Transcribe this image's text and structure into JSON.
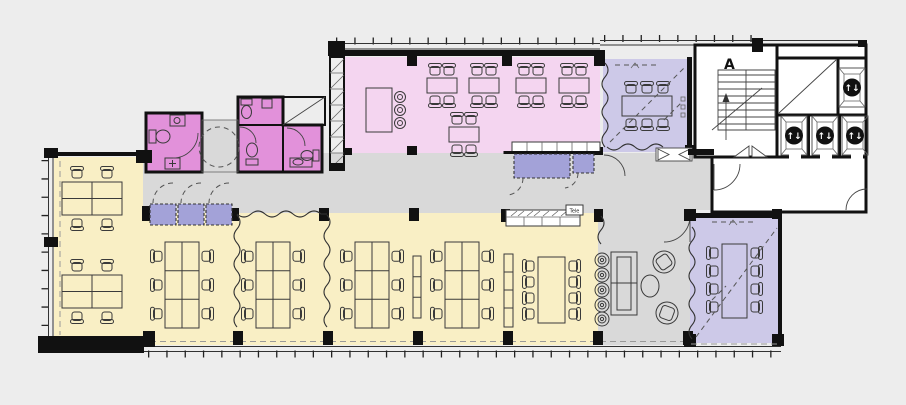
{
  "labels": {
    "stair_core": "A",
    "phone_booth": "Tele"
  },
  "icons": {
    "elevator": "↑↓"
  },
  "colors": {
    "background": "#ededed",
    "corridor": "#d9d9d9",
    "open_office": "#f9efc5",
    "cafeteria": "#f4d5f0",
    "sanitary": "#e291da",
    "meeting": "#cdc9e8",
    "storage": "#a3a2d8",
    "core": "#ffffff",
    "wall": "#111111"
  },
  "zones": [
    {
      "name": "open-office",
      "color_key": "open_office"
    },
    {
      "name": "cafeteria",
      "color_key": "cafeteria"
    },
    {
      "name": "sanitary-rooms",
      "color_key": "sanitary"
    },
    {
      "name": "meeting-rooms",
      "color_key": "meeting"
    },
    {
      "name": "storage-and-serving",
      "color_key": "storage"
    },
    {
      "name": "circulation-corridor-lounge",
      "color_key": "corridor"
    },
    {
      "name": "core-stairs-elevators-lobby",
      "color_key": "core"
    }
  ],
  "features": {
    "elevator_count": 4,
    "stair_count": 1,
    "meeting_room_seats": [
      6,
      8,
      8
    ],
    "cafeteria_tables": 5,
    "desk_clusters": [
      4,
      4,
      6,
      6,
      6,
      6
    ]
  }
}
